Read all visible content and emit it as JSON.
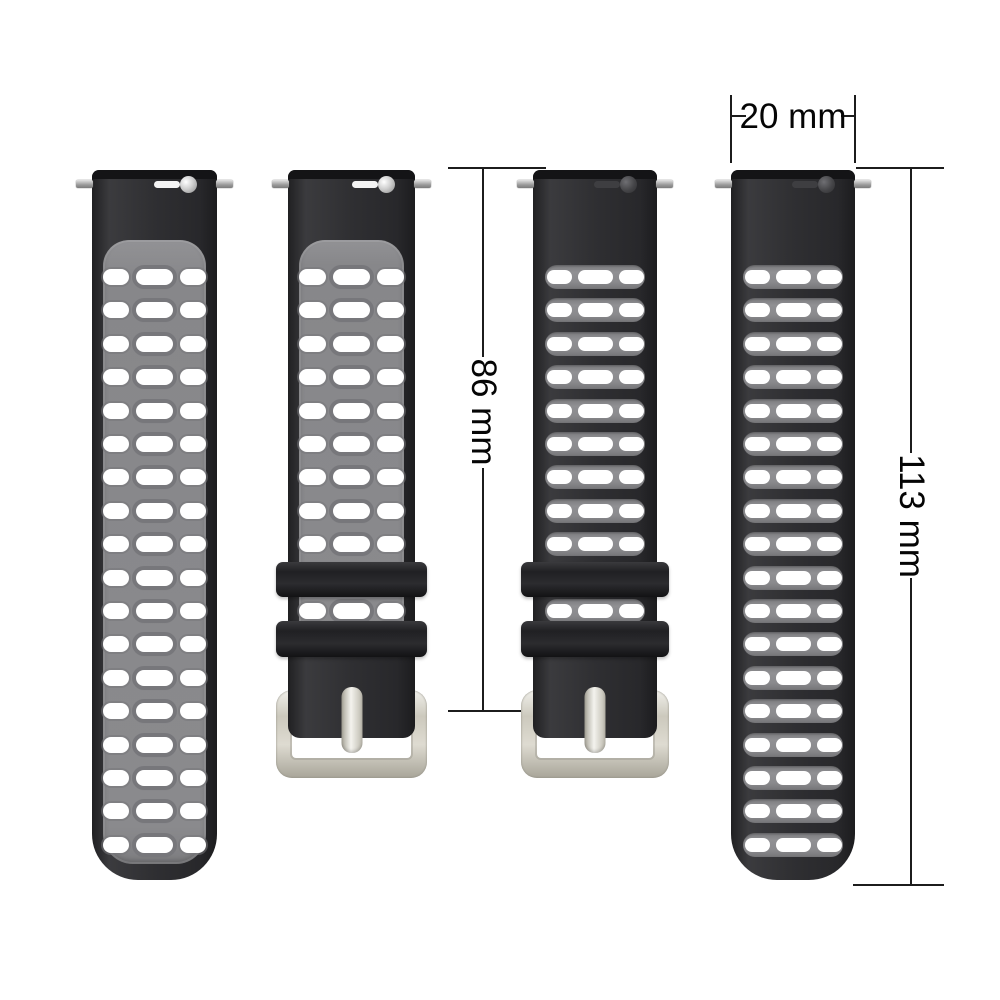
{
  "annotations": {
    "band_width_label": "20 mm",
    "buckle_side_length_label": "86 mm",
    "holes_side_length_label": "113 mm"
  },
  "colors": {
    "background": "#ffffff",
    "strap_black": "#2c2c2e",
    "strap_gray_panel": "#88888b",
    "hole_white": "#ffffff",
    "buckle_silver": "#d9d6ca",
    "dimension_line": "#1c1c1c"
  },
  "straps": [
    {
      "id": "gray-band-holes-side",
      "style": "two-tone-gray",
      "hole_rows": 18,
      "has_buckle": false
    },
    {
      "id": "gray-band-buckle-side",
      "style": "two-tone-gray",
      "hole_rows": 10,
      "has_buckle": true
    },
    {
      "id": "black-band-buckle-side",
      "style": "black",
      "hole_rows": 10,
      "has_buckle": true
    },
    {
      "id": "black-band-holes-side",
      "style": "black",
      "hole_rows": 18,
      "has_buckle": false
    }
  ]
}
